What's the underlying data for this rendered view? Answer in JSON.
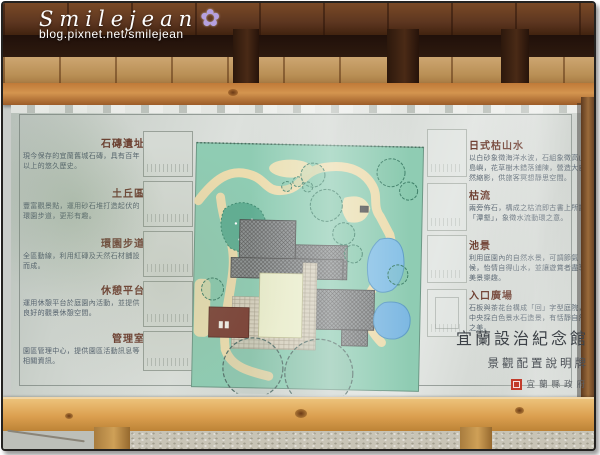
{
  "watermark": {
    "title": "Smilejean",
    "url": "blog.pixnet.net/smilejean",
    "flower_icon": "✿"
  },
  "sign": {
    "left_sections": [
      {
        "heading": "石磚遺址",
        "body": "現今保存的宜蘭舊城石磚，具有百年以上的悠久歷史。"
      },
      {
        "heading": "土丘區",
        "body": "豐富觀景點，運用砂石堆打造起伏的環園步道，更形有趣。"
      },
      {
        "heading": "環園步道",
        "body": "全區動線，利用紅磚及天然石材舖設而成。"
      },
      {
        "heading": "休憩平台",
        "body": "運用休憩平台於庭園內活動，並提供良好的觀景休憩空間。"
      },
      {
        "heading": "管理室",
        "body": "園區管理中心，提供園區活動訊息等相關資訊。"
      }
    ],
    "right_sections": [
      {
        "heading": "日式枯山水",
        "body": "以白砂象徵海洋水波，石組象徵高山島嶼，花草樹木錯落鋪陳，營造大自然縮影，供旅客冥想靜思空間。"
      },
      {
        "heading": "枯流",
        "body": "兩旁佈石，構成之枯流即古書上所謂「潭壑」，象徵水流動環之意。"
      },
      {
        "heading": "池景",
        "body": "利用庭園內的自然水景，可調節氣候，怡情自得山水，並讓遊賞者盡享美景樂趣。"
      },
      {
        "heading": "入口廣場",
        "body": "石板與茶花台構成「回」字型庭院，中央採白色景水石造景，有恬靜自然之美。"
      }
    ],
    "title_block": {
      "main_title": "宜蘭設治紀念館",
      "subtitle": "景觀配置說明牌",
      "agency": "宜蘭縣政府",
      "seal_icon": "red-seal-icon"
    },
    "colors": {
      "heading": "#6b3a2c",
      "body_text": "#55626e",
      "panel_silver": "#d5d9d5",
      "map_green": "#8fccb3",
      "path_cream": "#ecdcae",
      "pond_blue": "#86c0e6",
      "building_gray": "#8f9394",
      "red_building": "#7c4237",
      "seal_red": "#c23b2a",
      "beam_wood": "#c07a38",
      "rail_wood": "#dca050"
    }
  }
}
